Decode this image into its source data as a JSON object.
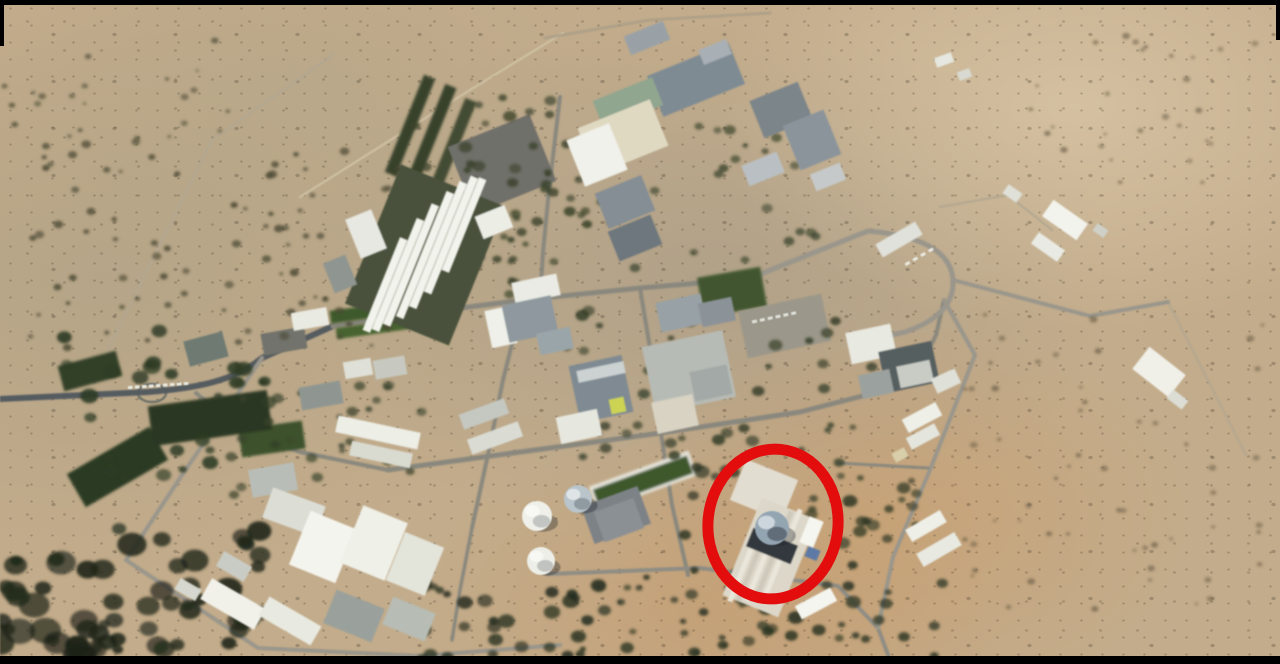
{
  "meta": {
    "width": 1280,
    "height": 664,
    "image_kind": "satellite-photo"
  },
  "palette": {
    "letterbox": "#000000",
    "desert_base": "#c3ac8b",
    "road_gray": "#8a887e",
    "road_dark": "#555c60",
    "road_light": "#9a968b",
    "vegetation_dark": "#20261a",
    "building_white": "#f2f3ec",
    "reactor_dome_silver": "#93a5b3",
    "annotation_red": "#e30d0d"
  },
  "annotation": {
    "shape": "ellipse",
    "cx": 773,
    "cy": 524,
    "rx": 65,
    "ry": 75,
    "rot": 6,
    "stroke": "#e30d0d",
    "stroke_width": 11
  },
  "scene": {
    "field_fields": [
      "x",
      "y",
      "w",
      "h",
      "rot",
      "color"
    ],
    "tracks": [
      {
        "d": "M 107 352 L 212 140 L 333 55",
        "w": 3,
        "c": "#b3a78e",
        "o": 0.8
      },
      {
        "d": "M 300 197 L 470 90 L 563 33",
        "w": 2.5,
        "c": "#cfc1a2",
        "o": 0.85
      },
      {
        "d": "M 545 38 L 650 20 L 770 13",
        "w": 3,
        "c": "#a89d86",
        "o": 0.7
      },
      {
        "d": "M 940 207 L 1008 195 L 1052 230",
        "w": 2.5,
        "c": "#b3a78e",
        "o": 0.8
      },
      {
        "d": "M 1168 302 L 1246 455",
        "w": 3,
        "c": "#b3a78e",
        "o": 0.7
      },
      {
        "d": "M 138 393 a 14 9 0 1 0 28 0 a 14 9 0 1 0 -28 0",
        "w": 2.5,
        "c": "#6a7068",
        "o": 0.9
      }
    ],
    "roads": [
      {
        "d": "M 0 399 L 148 392 C 200 388 235 380 262 358 L 333 326",
        "w": 6,
        "c": "#555c60"
      },
      {
        "d": "M 196 393 L 240 430 L 300 452 L 388 470",
        "w": 4,
        "c": "#8a887e"
      },
      {
        "d": "M 262 358 L 180 478 L 126 560",
        "w": 4,
        "c": "#9a968b"
      },
      {
        "d": "M 126 560 L 258 648 L 420 656 L 560 645",
        "w": 4,
        "c": "#9a968b"
      },
      {
        "d": "M 333 326 L 430 312 L 523 300 L 640 288 L 748 279",
        "w": 5,
        "c": "#8a887e"
      },
      {
        "d": "M 560 97 L 549 190 L 543 252 L 540 300",
        "w": 4,
        "c": "#8a887e"
      },
      {
        "d": "M 640 288 L 652 360 L 661 433",
        "w": 4,
        "c": "#8a887e"
      },
      {
        "d": "M 523 300 L 503 380 L 489 450 L 472 528",
        "w": 4,
        "c": "#8a887e"
      },
      {
        "d": "M 388 470 L 520 452 L 661 433 L 800 412 L 882 391",
        "w": 5,
        "c": "#8a887e"
      },
      {
        "d": "M 661 433 L 672 505 L 688 575",
        "w": 4,
        "c": "#8a887e"
      },
      {
        "d": "M 548 574 L 700 568 L 838 586 L 878 628 L 890 660",
        "w": 4,
        "c": "#8f8d84"
      },
      {
        "d": "M 882 391 Q 920 372 936 335 L 944 300",
        "w": 4,
        "c": "#8a887e"
      },
      {
        "d": "M 748 279 L 868 231 Q 950 238 953 280 Q 955 315 905 332 L 870 340",
        "w": 5,
        "c": "#9a968b"
      },
      {
        "d": "M 953 280 L 1090 316 L 1168 302",
        "w": 4,
        "c": "#9a968b"
      },
      {
        "d": "M 944 300 L 975 355 L 930 470 L 893 557 L 878 628",
        "w": 4,
        "c": "#9a968b"
      },
      {
        "d": "M 838 463 L 928 468",
        "w": 3,
        "c": "#8a887e"
      },
      {
        "d": "M 472 528 L 460 590 L 452 640",
        "w": 3.5,
        "c": "#8a887e"
      }
    ],
    "lawns": [
      [
        330,
        305,
        84,
        13,
        -8,
        "#3d5a2c"
      ],
      [
        336,
        322,
        88,
        11,
        -8,
        "#46632f"
      ],
      [
        590,
        468,
        106,
        26,
        -20,
        "#e6e6dc"
      ],
      [
        593,
        472,
        100,
        19,
        -20,
        "#3c582b"
      ],
      [
        700,
        272,
        64,
        40,
        -10,
        "#3f572d"
      ],
      [
        240,
        425,
        64,
        28,
        -8,
        "#3a512a"
      ],
      [
        404,
        73,
        12,
        105,
        22,
        "#39422a"
      ],
      [
        424,
        82,
        12,
        112,
        22,
        "#39422a"
      ],
      [
        444,
        96,
        12,
        112,
        22,
        "#434c30"
      ],
      [
        70,
        448,
        95,
        38,
        -30,
        "#2c3a21"
      ],
      [
        150,
        398,
        120,
        40,
        -8,
        "#2b3822"
      ],
      [
        60,
        358,
        60,
        26,
        -15,
        "#314026"
      ]
    ],
    "paved": [
      [
        458,
        128,
        88,
        72,
        -22,
        "#6f706b"
      ],
      [
        262,
        330,
        44,
        22,
        -10,
        "#72736c"
      ],
      [
        586,
        495,
        60,
        40,
        -20,
        "#7d8287"
      ],
      [
        742,
        302,
        85,
        48,
        -12,
        "#9b9789"
      ]
    ],
    "shrub_areas": [
      {
        "x": 20,
        "y": 140,
        "w": 380,
        "h": 215,
        "n": 85,
        "rmin": 2,
        "rmax": 5,
        "c": "#4c4a33",
        "o": 0.85,
        "seed": 1
      },
      {
        "x": 0,
        "y": 40,
        "w": 230,
        "h": 100,
        "n": 22,
        "rmin": 1.5,
        "rmax": 4,
        "c": "#55523a",
        "o": 0.8,
        "seed": 2
      },
      {
        "x": 0,
        "y": 528,
        "w": 280,
        "h": 130,
        "n": 48,
        "rmin": 6,
        "rmax": 16,
        "c": "#20261a",
        "o": 0.9,
        "seed": 3
      },
      {
        "x": 420,
        "y": 580,
        "w": 190,
        "h": 80,
        "n": 30,
        "rmin": 4,
        "rmax": 9,
        "c": "#232c1d",
        "o": 0.9,
        "seed": 4
      },
      {
        "x": 565,
        "y": 575,
        "w": 380,
        "h": 85,
        "n": 38,
        "rmin": 3,
        "rmax": 7,
        "c": "#2a3321",
        "o": 0.85,
        "seed": 5
      },
      {
        "x": 955,
        "y": 300,
        "w": 310,
        "h": 320,
        "n": 55,
        "rmin": 1.5,
        "rmax": 4,
        "c": "#6e6148",
        "o": 0.7,
        "seed": 6
      },
      {
        "x": 1010,
        "y": 35,
        "w": 260,
        "h": 160,
        "n": 28,
        "rmin": 1.5,
        "rmax": 4,
        "c": "#6e6148",
        "o": 0.7,
        "seed": 7
      },
      {
        "x": 380,
        "y": 95,
        "w": 200,
        "h": 130,
        "n": 26,
        "rmin": 3,
        "rmax": 7,
        "c": "#3a4129",
        "o": 0.85,
        "seed": 8
      },
      {
        "x": 430,
        "y": 170,
        "w": 160,
        "h": 150,
        "n": 30,
        "rmin": 3,
        "rmax": 6,
        "c": "#374027",
        "o": 0.85,
        "seed": 9
      },
      {
        "x": 560,
        "y": 300,
        "w": 330,
        "h": 165,
        "n": 48,
        "rmin": 3,
        "rmax": 7,
        "c": "#333c26",
        "o": 0.85,
        "seed": 10
      },
      {
        "x": 680,
        "y": 455,
        "w": 175,
        "h": 175,
        "n": 32,
        "rmin": 4,
        "rmax": 8,
        "c": "#2c3522",
        "o": 0.9,
        "seed": 11
      },
      {
        "x": 225,
        "y": 380,
        "w": 200,
        "h": 115,
        "n": 26,
        "rmin": 3,
        "rmax": 6,
        "c": "#3a422b",
        "o": 0.85,
        "seed": 12
      },
      {
        "x": 40,
        "y": 330,
        "w": 240,
        "h": 150,
        "n": 30,
        "rmin": 4,
        "rmax": 10,
        "c": "#2e3b24",
        "o": 0.9,
        "seed": 13
      },
      {
        "x": 600,
        "y": 120,
        "w": 220,
        "h": 150,
        "n": 26,
        "rmin": 3,
        "rmax": 6,
        "c": "#3c452c",
        "o": 0.8,
        "seed": 14
      },
      {
        "x": 0,
        "y": 620,
        "w": 120,
        "h": 40,
        "n": 18,
        "rmin": 5,
        "rmax": 12,
        "c": "#1c2217",
        "o": 0.9,
        "seed": 15
      },
      {
        "x": 840,
        "y": 440,
        "w": 80,
        "h": 100,
        "n": 14,
        "rmin": 3,
        "rmax": 7,
        "c": "#2f3823",
        "o": 0.85,
        "seed": 16
      }
    ],
    "buildings": [
      [
        369,
        180,
        112,
        150,
        22,
        "#49513b"
      ],
      [
        652,
        58,
        88,
        44,
        -22,
        "#7e8b94"
      ],
      [
        700,
        44,
        30,
        16,
        -22,
        "#a9b0b5"
      ],
      [
        626,
        28,
        42,
        20,
        -22,
        "#99a1a7"
      ],
      [
        596,
        88,
        64,
        30,
        -22,
        "#8fa68e"
      ],
      [
        584,
        112,
        78,
        50,
        -22,
        "#e0d9c1"
      ],
      [
        574,
        130,
        46,
        50,
        -22,
        "#f0f1ea"
      ],
      [
        600,
        183,
        50,
        38,
        -22,
        "#848e94"
      ],
      [
        612,
        222,
        46,
        32,
        -22,
        "#6d777d"
      ],
      [
        478,
        210,
        32,
        24,
        -22,
        "#eceee6"
      ],
      [
        755,
        90,
        52,
        40,
        -22,
        "#7b8589"
      ],
      [
        790,
        116,
        44,
        48,
        -22,
        "#8b949b"
      ],
      [
        744,
        158,
        38,
        22,
        -22,
        "#b9bfc2"
      ],
      [
        812,
        168,
        32,
        18,
        -22,
        "#c6c9c9"
      ],
      [
        352,
        213,
        28,
        42,
        -22,
        "#e7e8e1"
      ],
      [
        328,
        258,
        24,
        32,
        -22,
        "#8f9590"
      ],
      [
        935,
        55,
        18,
        10,
        -20,
        "#e6e7e0"
      ],
      [
        958,
        70,
        13,
        9,
        -20,
        "#d8dad2"
      ],
      [
        292,
        310,
        36,
        18,
        -10,
        "#e9eae2"
      ],
      [
        344,
        360,
        28,
        17,
        -10,
        "#dfe1d8"
      ],
      [
        374,
        358,
        32,
        19,
        -10,
        "#c7c9c0"
      ],
      [
        300,
        384,
        42,
        23,
        -10,
        "#8f9691"
      ],
      [
        336,
        424,
        84,
        17,
        12,
        "#edeee6"
      ],
      [
        350,
        447,
        62,
        15,
        12,
        "#d9dad0"
      ],
      [
        186,
        336,
        40,
        26,
        -15,
        "#6e7a72"
      ],
      [
        488,
        308,
        26,
        38,
        -12,
        "#eef0e9"
      ],
      [
        513,
        278,
        46,
        22,
        -12,
        "#e9ebe4"
      ],
      [
        505,
        300,
        50,
        38,
        -12,
        "#8e989e"
      ],
      [
        538,
        330,
        34,
        22,
        -12,
        "#9aa5a9"
      ],
      [
        574,
        360,
        54,
        58,
        -12,
        "#7e8a93"
      ],
      [
        577,
        366,
        48,
        12,
        -12,
        "#ccd2d1"
      ],
      [
        610,
        398,
        15,
        15,
        -12,
        "#cdd44e"
      ],
      [
        648,
        338,
        82,
        68,
        -12,
        "#b7bbb5"
      ],
      [
        658,
        298,
        46,
        30,
        -12,
        "#98a1a6"
      ],
      [
        700,
        300,
        34,
        24,
        -12,
        "#8b9298"
      ],
      [
        654,
        398,
        42,
        32,
        -12,
        "#d8d3c2"
      ],
      [
        692,
        368,
        38,
        30,
        -12,
        "#a3a9a6"
      ],
      [
        460,
        406,
        48,
        16,
        -20,
        "#c5c8c1"
      ],
      [
        468,
        430,
        54,
        16,
        -20,
        "#dadcd4"
      ],
      [
        558,
        413,
        42,
        27,
        -12,
        "#e6e7df"
      ],
      [
        848,
        328,
        46,
        32,
        -12,
        "#e8e9e1"
      ],
      [
        882,
        346,
        54,
        42,
        -12,
        "#565e60"
      ],
      [
        860,
        372,
        32,
        24,
        -12,
        "#9ba19e"
      ],
      [
        898,
        363,
        34,
        22,
        -12,
        "#c9ccc5"
      ],
      [
        933,
        373,
        26,
        16,
        -25,
        "#dfe0d8"
      ],
      [
        876,
        232,
        46,
        15,
        -30,
        "#dfe1da"
      ],
      [
        903,
        410,
        38,
        15,
        -28,
        "#eef0e8"
      ],
      [
        907,
        430,
        32,
        13,
        -28,
        "#e4e6de"
      ],
      [
        893,
        450,
        14,
        10,
        -28,
        "#d8cfa8"
      ],
      [
        906,
        519,
        40,
        14,
        -30,
        "#eef0e8"
      ],
      [
        917,
        542,
        44,
        15,
        -30,
        "#e8eae2"
      ],
      [
        250,
        466,
        46,
        28,
        -10,
        "#b9bdb7"
      ],
      [
        266,
        496,
        56,
        32,
        20,
        "#dcded6"
      ],
      [
        298,
        518,
        50,
        58,
        22,
        "#f4f4ee"
      ],
      [
        350,
        512,
        48,
        62,
        22,
        "#eff0e8"
      ],
      [
        394,
        538,
        42,
        52,
        22,
        "#e3e4da"
      ],
      [
        202,
        592,
        62,
        24,
        30,
        "#f1f1ea"
      ],
      [
        260,
        610,
        60,
        22,
        30,
        "#e8e9e0"
      ],
      [
        328,
        598,
        52,
        36,
        22,
        "#9aa09b"
      ],
      [
        386,
        604,
        46,
        30,
        22,
        "#b7bcb4"
      ],
      [
        218,
        558,
        32,
        17,
        30,
        "#c9ccc5"
      ],
      [
        176,
        583,
        24,
        13,
        30,
        "#d6d8d0"
      ],
      [
        598,
        504,
        42,
        32,
        -20,
        "#8a9094"
      ],
      [
        736,
        468,
        56,
        44,
        22,
        "#e2ddd0"
      ],
      [
        740,
        505,
        60,
        105,
        22,
        "#dcd7c8"
      ],
      [
        744,
        515,
        5,
        90,
        22,
        "#eae6d9"
      ],
      [
        753,
        512,
        5,
        92,
        22,
        "#cfc9ba"
      ],
      [
        762,
        510,
        5,
        94,
        22,
        "#eae6d9"
      ],
      [
        771,
        508,
        5,
        95,
        22,
        "#cfc9ba"
      ],
      [
        780,
        506,
        5,
        95,
        22,
        "#eae6d9"
      ],
      [
        748,
        536,
        48,
        20,
        22,
        "#33383c"
      ],
      [
        804,
        518,
        15,
        28,
        22,
        "#f5f6f0"
      ],
      [
        806,
        548,
        13,
        11,
        22,
        "#5b79a8"
      ],
      [
        796,
        596,
        40,
        15,
        -28,
        "#f4f5ef"
      ],
      [
        1044,
        210,
        42,
        20,
        35,
        "#f3f3ed"
      ],
      [
        1032,
        240,
        32,
        14,
        35,
        "#e9eae3"
      ],
      [
        1004,
        188,
        17,
        11,
        35,
        "#dfe0d8"
      ],
      [
        1094,
        226,
        13,
        9,
        35,
        "#cfd1c9"
      ],
      [
        1136,
        358,
        46,
        28,
        38,
        "#f0f0e9"
      ],
      [
        1168,
        394,
        19,
        11,
        38,
        "#dcded6"
      ]
    ],
    "strips": {
      "rot": 22,
      "width": 8,
      "color": "#f2f3ec",
      "fields": [
        "cx",
        "cy",
        "len"
      ],
      "items": [
        [
          385,
          285,
          100
        ],
        [
          398,
          275,
          120
        ],
        [
          411,
          265,
          130
        ],
        [
          425,
          255,
          135
        ],
        [
          438,
          245,
          135
        ],
        [
          451,
          235,
          125
        ],
        [
          464,
          225,
          100
        ]
      ]
    },
    "cars": [
      {
        "x": 128,
        "y": 386,
        "n": 9,
        "step": 7,
        "w": 4.5,
        "h": 3,
        "rot": -4,
        "c": "#e9e9e1"
      },
      {
        "x": 752,
        "y": 320,
        "n": 6,
        "step": 8,
        "w": 5,
        "h": 3,
        "rot": -12,
        "c": "#dfe0d8"
      },
      {
        "x": 905,
        "y": 262,
        "n": 4,
        "step": 9,
        "w": 5,
        "h": 3,
        "rot": -30,
        "c": "#e9e9e1"
      }
    ],
    "domes": [
      {
        "cx": 537,
        "cy": 516,
        "r": 15,
        "c": "#eff0e9",
        "shade": 0.22,
        "name": "storage-dome-white-1"
      },
      {
        "cx": 578,
        "cy": 499,
        "r": 14,
        "c": "#b9c4cb",
        "shade": 0.28,
        "name": "storage-dome-blue"
      },
      {
        "cx": 541,
        "cy": 561,
        "r": 14,
        "c": "#edeee7",
        "shade": 0.22,
        "name": "storage-dome-white-2"
      },
      {
        "cx": 772,
        "cy": 528,
        "r": 17,
        "c": "#93a5b3",
        "shade": 0.45,
        "name": "reactor-dome"
      }
    ]
  }
}
